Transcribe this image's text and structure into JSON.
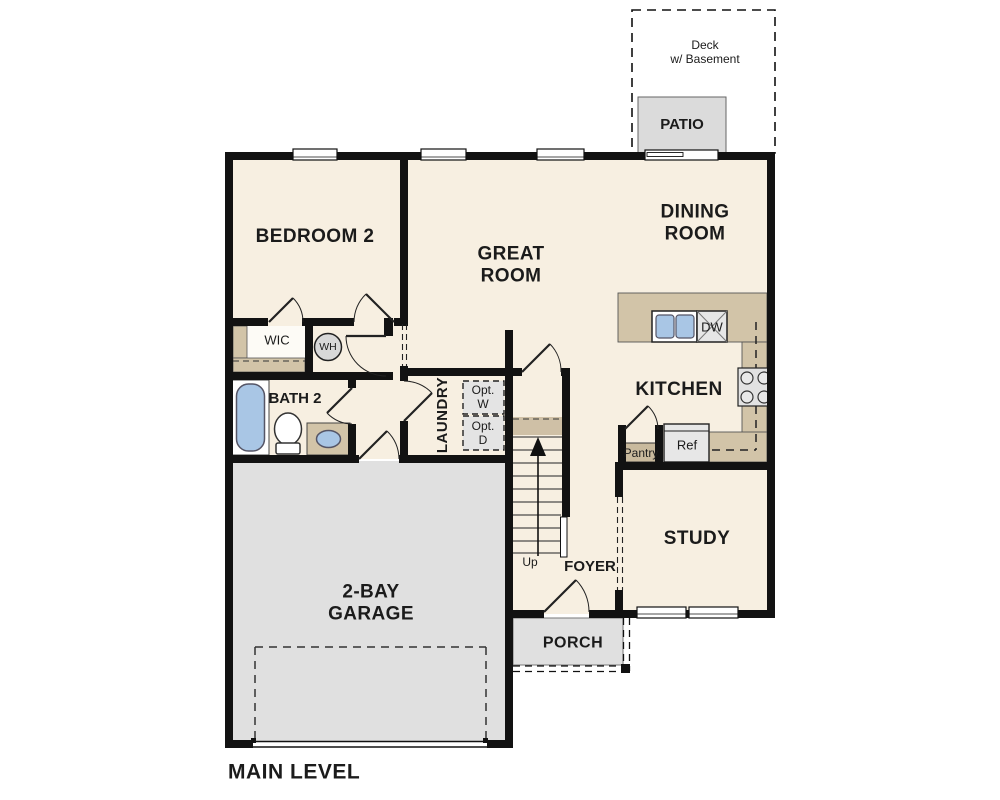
{
  "plan": {
    "title": "MAIN LEVEL",
    "colors": {
      "wall": "#121212",
      "floor_cream": "#f7efe1",
      "floor_gray": "#e0e0e0",
      "patio_gray": "#dbdbdb",
      "counter_tan": "#d2c4a8",
      "fixture_blue": "#a9c6e5",
      "fixture_gray": "#d8d8d8"
    },
    "rooms": {
      "deck": {
        "line1": "Deck",
        "line2": "w/ Basement"
      },
      "patio": {
        "label": "PATIO"
      },
      "dining": {
        "line1": "DINING",
        "line2": "ROOM"
      },
      "great": {
        "line1": "GREAT",
        "line2": "ROOM"
      },
      "bedroom2": {
        "label": "BEDROOM 2"
      },
      "wic": {
        "label": "WIC"
      },
      "water_heater": {
        "label": "WH"
      },
      "bath2": {
        "label": "BATH 2"
      },
      "laundry": {
        "label": "LAUNDRY",
        "opt_washer": {
          "line1": "Opt.",
          "line2": "W"
        },
        "opt_dryer": {
          "line1": "Opt.",
          "line2": "D"
        }
      },
      "kitchen": {
        "label": "KITCHEN",
        "dishwasher": "DW",
        "refrigerator": "Ref",
        "pantry": "Pantry"
      },
      "study": {
        "label": "STUDY"
      },
      "foyer": {
        "label": "FOYER"
      },
      "stairs": {
        "label": "Up"
      },
      "porch": {
        "label": "PORCH"
      },
      "garage": {
        "line1": "2-BAY",
        "line2": "GARAGE"
      }
    }
  }
}
